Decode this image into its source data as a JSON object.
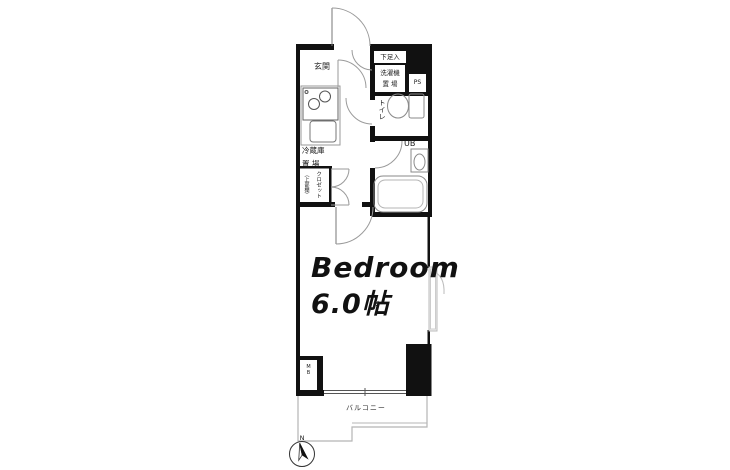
{
  "floor_plan": {
    "labels": {
      "entrance": "玄関",
      "shoe_box": "下足入",
      "washer_line1": "洗濯機",
      "washer_line2": "置 場",
      "pipe_space": "PS",
      "toilet": "トイレ",
      "unit_bath": "UB",
      "fridge_line1": "冷蔵庫",
      "fridge_line2": "置 場",
      "closet_name": "クロゼット",
      "closet_note": "（上部棚）",
      "meter_box": "MB",
      "bedroom_name": "Bedroom",
      "bedroom_size": "6.0帖",
      "bedroom_note": "※",
      "balcony": "バルコニー",
      "north": "N"
    },
    "colors": {
      "wall": "#111111",
      "fixture_line": "#8a8a8a",
      "light_line": "#bbbbbb",
      "balcony_line": "#b5b5b5",
      "background": "#ffffff",
      "text": "#1a1a1a"
    }
  }
}
